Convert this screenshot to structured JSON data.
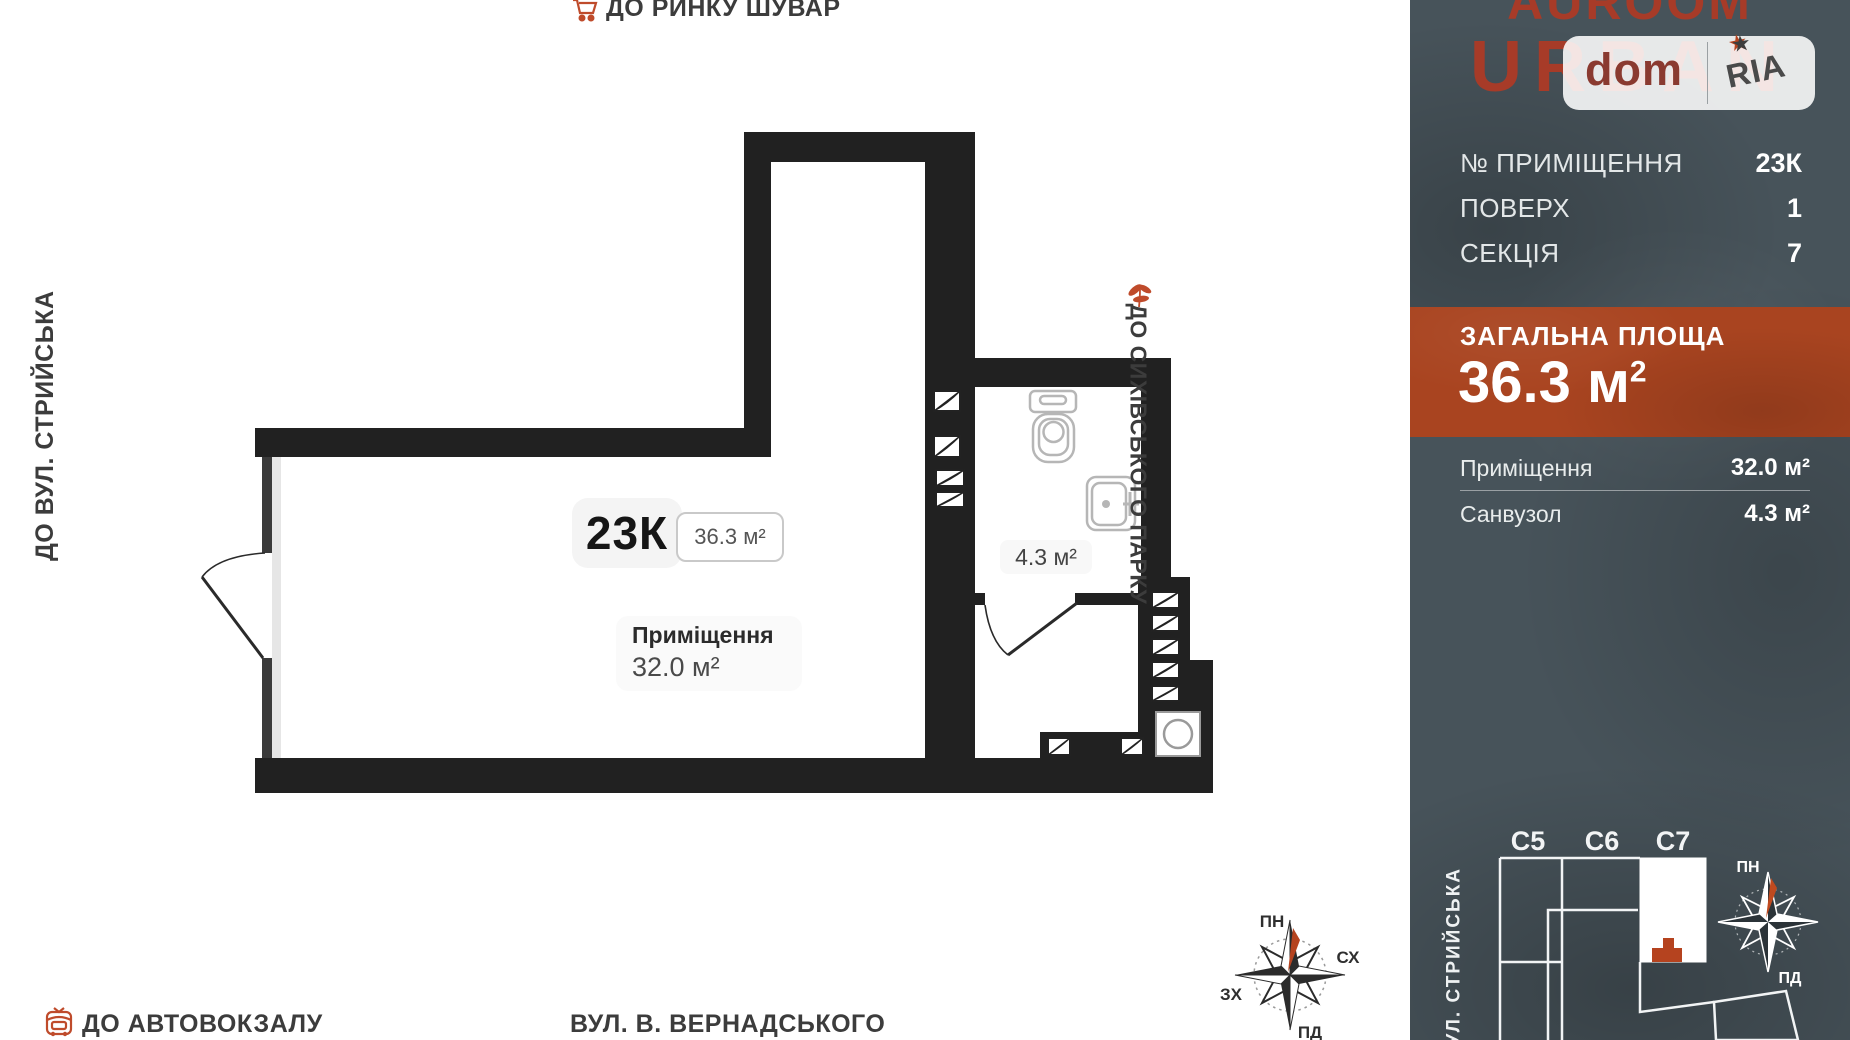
{
  "plan": {
    "unit_badge": "23К",
    "unit_area": "36.3 м²",
    "room_label": "Приміщення",
    "room_area": "32.0 м²",
    "bathroom_area": "4.3 м²",
    "labels": {
      "top": {
        "prefix": "ДО",
        "name": "РИНКУ ШУВАР"
      },
      "left": {
        "prefix": "ДО",
        "name": "ВУЛ. СТРИЙСЬКА"
      },
      "right": {
        "prefix": "ДО",
        "name": "СИХІВСЬКОГО ПАРКУ"
      },
      "bottom_left": {
        "prefix": "ДО",
        "name": "АВТОВОКЗАЛУ"
      },
      "bottom_center": "ВУЛ. В. ВЕРНАДСЬКОГО"
    },
    "compass": {
      "n": "ПН",
      "e": "СХ",
      "w": "ЗХ",
      "s": "ПД"
    }
  },
  "sidebar": {
    "brand_line1": "AUROOM",
    "brand_line2": "URBAN",
    "watermark": {
      "left": "dom",
      "right": "RIA",
      "star": "★"
    },
    "info_rows": [
      {
        "label": "№ ПРИМІЩЕННЯ",
        "value": "23К"
      },
      {
        "label": "ПОВЕРХ",
        "value": "1"
      },
      {
        "label": "СЕКЦІЯ",
        "value": "7"
      }
    ],
    "total_area": {
      "label": "ЗАГАЛЬНА ПЛОЩА",
      "value": "36.3 м",
      "sup": "2"
    },
    "area_rows": [
      {
        "label": "Приміщення",
        "value": "32.0 м²"
      },
      {
        "label": "Санвузол",
        "value": "4.3 м²"
      }
    ],
    "minimap": {
      "sections": [
        "С5",
        "С6",
        "С7"
      ],
      "street": "ВУЛ. СТРИЙСЬКА",
      "compass": {
        "n": "ПН",
        "s": "ПД"
      }
    }
  },
  "colors": {
    "accent_orange": "#b5431f",
    "wall": "#212121",
    "sidebar_bg": "#47535a",
    "banner": "#a94420",
    "brand_red": "#a73b28"
  }
}
